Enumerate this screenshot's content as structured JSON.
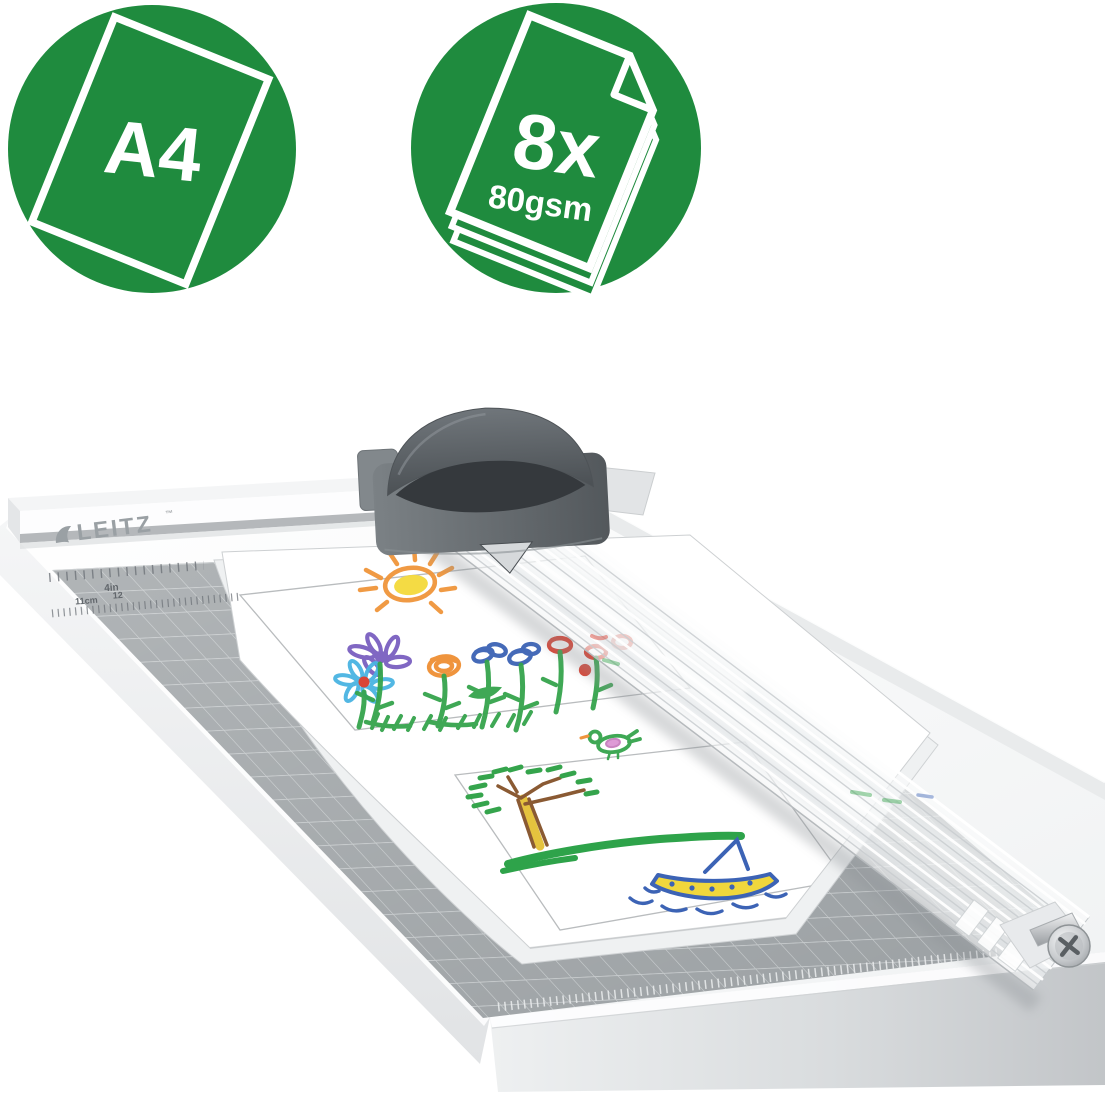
{
  "page": {
    "kind": "product-marketing-image",
    "background": "#ffffff"
  },
  "badges": {
    "size": {
      "label": "A4",
      "circle_color": "#1f8b3e",
      "text_color": "#ffffff",
      "icon": "tilted-a4-sheet-outline"
    },
    "capacity": {
      "count": "8x",
      "weight": "80gsm",
      "circle_color": "#1f8b3e",
      "text_color": "#ffffff",
      "icon": "paper-stack-folded-corner"
    }
  },
  "trimmer": {
    "brand": "LEITZ",
    "trademark": "™",
    "ruler": {
      "inch_label": "4in",
      "cm_label": "11cm",
      "cm_next_label": "12"
    },
    "colors": {
      "base": "#fbfcfd",
      "mat": "#9ba0a3",
      "mat_grid_line": "#c5c9cb",
      "cutter_head": "#5d6367",
      "logo": "#9aa0a4",
      "rail_tint": "rgba(244,246,248,0.8)"
    },
    "artwork_motifs": [
      "sun",
      "flowers",
      "bird",
      "tree",
      "sailboat"
    ]
  }
}
